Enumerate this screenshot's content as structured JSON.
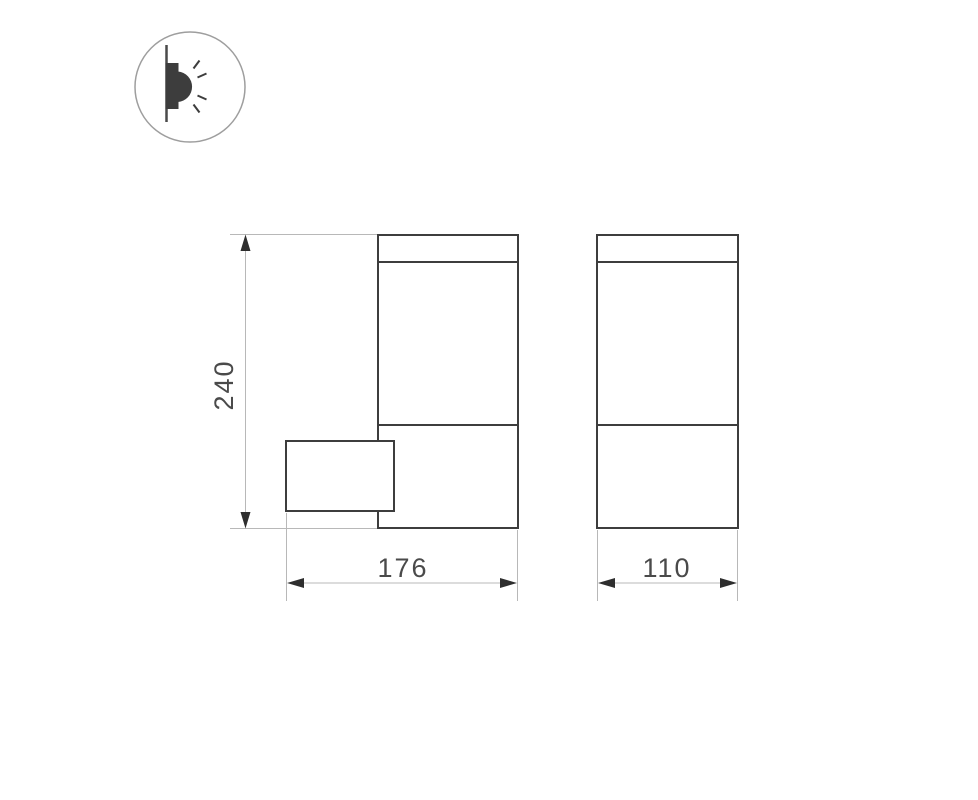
{
  "drawing": {
    "type": "technical-dimension-drawing",
    "subject": "wall-mounted-luminaire",
    "icon": "wall-light-pictogram",
    "views": {
      "side": "side-view-with-mounting-box",
      "front": "front-view"
    },
    "dimensions": {
      "height": "240",
      "side_width": "176",
      "front_width": "110"
    },
    "colors": {
      "outline": "#3d3d3d",
      "dimension_line": "#b8b8b8",
      "arrow": "#2e2e2e",
      "text": "#4a4a4a",
      "icon_circle": "#9e9e9e",
      "background": "#ffffff"
    }
  }
}
